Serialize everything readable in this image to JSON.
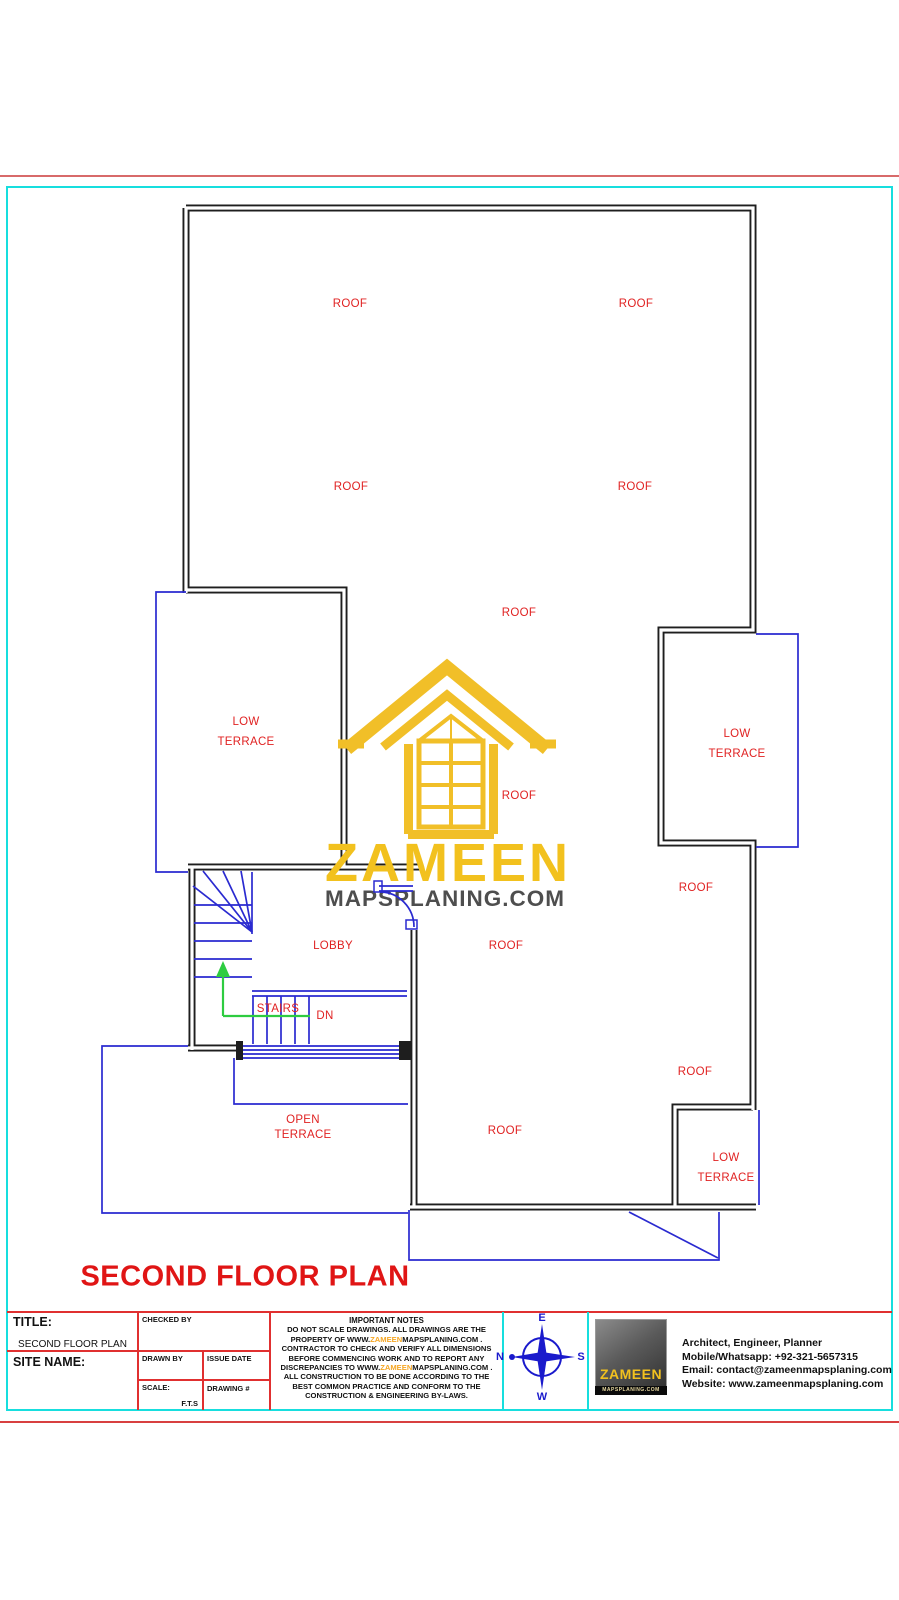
{
  "colors": {
    "wall": "#1e1e1e",
    "cad_blue": "#2a2ad0",
    "label_red": "#e02222",
    "border_cyan": "#17dede",
    "grid_red": "#e03030",
    "stair_green": "#2ecc40",
    "brand_yellow": "#f2c11e",
    "brand_gray": "#4e4e4e",
    "notes_orange": "#f5a623"
  },
  "plan": {
    "drawing_title": "SECOND FLOOR PLAN",
    "labels": [
      {
        "name": "roof-label-1",
        "text": "ROOF",
        "x": 350,
        "y": 304
      },
      {
        "name": "roof-label-2",
        "text": "ROOF",
        "x": 636,
        "y": 304
      },
      {
        "name": "roof-label-3",
        "text": "ROOF",
        "x": 351,
        "y": 487
      },
      {
        "name": "roof-label-4",
        "text": "ROOF",
        "x": 635,
        "y": 487
      },
      {
        "name": "roof-label-5",
        "text": "ROOF",
        "x": 519,
        "y": 613
      },
      {
        "name": "roof-label-6",
        "text": "ROOF",
        "x": 519,
        "y": 796
      },
      {
        "name": "roof-label-7",
        "text": "ROOF",
        "x": 696,
        "y": 888
      },
      {
        "name": "roof-label-8",
        "text": "ROOF",
        "x": 506,
        "y": 946
      },
      {
        "name": "roof-label-9",
        "text": "ROOF",
        "x": 695,
        "y": 1072
      },
      {
        "name": "roof-label-10",
        "text": "ROOF",
        "x": 505,
        "y": 1131
      },
      {
        "name": "low-terrace-left-label",
        "text": "LOW\nTERRACE",
        "x": 246,
        "y": 732,
        "lh": 20
      },
      {
        "name": "low-terrace-right-label",
        "text": "LOW\nTERRACE",
        "x": 737,
        "y": 744,
        "lh": 20
      },
      {
        "name": "low-terrace-bottom-label",
        "text": "LOW\nTERRACE",
        "x": 726,
        "y": 1168,
        "lh": 20
      },
      {
        "name": "lobby-label",
        "text": "LOBBY",
        "x": 333,
        "y": 946
      },
      {
        "name": "stairs-label",
        "text": "STAIRS",
        "x": 278,
        "y": 1009
      },
      {
        "name": "dn-label",
        "text": "DN",
        "x": 325,
        "y": 1016
      },
      {
        "name": "open-terrace-label",
        "text": "OPEN\nTERRACE",
        "x": 303,
        "y": 1128,
        "lh": 15
      }
    ]
  },
  "watermark": {
    "brand": "ZAMEEN",
    "domain": "MAPSPLANING.COM"
  },
  "title_block": {
    "title_label": "TITLE:",
    "title_value": "SECOND FLOOR PLAN",
    "site_name_label": "SITE NAME:",
    "checked_by_label": "CHECKED BY",
    "drawn_by_label": "DRAWN BY",
    "issue_date_label": "ISSUE DATE",
    "scale_label": "SCALE:",
    "scale_value": "F.T.S",
    "drawing_no_label": "DRAWING #",
    "notes_title": "IMPORTANT NOTES",
    "notes_lines": [
      "DO NOT SCALE DRAWINGS. ALL DRAWINGS ARE THE",
      "PROPERTY OF  WWW.ZAMEENMAPSPLANING.COM .",
      "CONTRACTOR TO CHECK AND VERIFY ALL DIMENSIONS",
      "BEFORE COMMENCING WORK AND TO REPORT ANY",
      "DISCREPANCIES TO WWW.ZAMEENMAPSPLANING.COM .",
      "ALL CONSTRUCTION TO BE DONE ACCORDING TO THE",
      "BEST COMMON PRACTICE AND CONFORM TO THE",
      "CONSTRUCTION & ENGINEERING BY-LAWS."
    ],
    "compass": {
      "north": "N",
      "east": "E",
      "south": "S",
      "west": "W"
    },
    "logo": {
      "brand": "ZAMEEN",
      "domain": "MAPSPLANING.COM"
    },
    "contact": {
      "line1": "Architect, Engineer, Planner",
      "line2": "Mobile/Whatsapp: +92-321-5657315",
      "line3": "Email: contact@zameenmapsplaning.com",
      "line4": "Website: www.zameenmapsplaning.com"
    }
  }
}
